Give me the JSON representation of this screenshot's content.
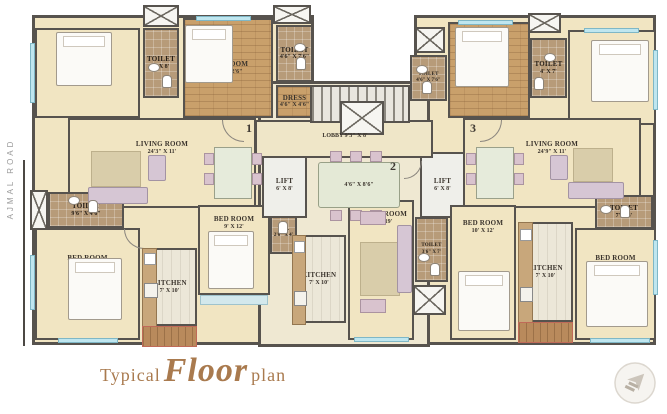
{
  "title": {
    "prefix": "Typical",
    "script": "Floor",
    "suffix": "plan"
  },
  "road_label": "AJMAL ROAD",
  "unit_markers": [
    "1",
    "2",
    "3"
  ],
  "lobby": {
    "name": "LOBBY",
    "dims": "9'3\" X 8'"
  },
  "central_table_dims": "4'6\" X 8'6\"",
  "rooms": [
    {
      "id": "bed-tl1",
      "name": "BED ROOM",
      "dims": "13'6\" X 10'6\""
    },
    {
      "id": "toilet-tl",
      "name": "TOILET",
      "dims": "4' X 8'"
    },
    {
      "id": "bed-tl2",
      "name": "BED ROOM",
      "dims": "13' X 12'6\""
    },
    {
      "id": "toilet-t2",
      "name": "TOILET",
      "dims": "4'6\" X 7'6\""
    },
    {
      "id": "dress-1",
      "name": "DRESS",
      "dims": "4'6\" X 4'6\""
    },
    {
      "id": "living-left",
      "name": "LIVING ROOM",
      "dims": "24'3\" X 11'"
    },
    {
      "id": "toilet-left",
      "name": "TOILET",
      "dims": "9'6\" X 4'6\""
    },
    {
      "id": "bed-bl",
      "name": "BED ROOM",
      "dims": "13' X 10'9\""
    },
    {
      "id": "kitchen-left",
      "name": "KITCHEN",
      "dims": "7' X 10'"
    },
    {
      "id": "bed-bc",
      "name": "BED ROOM",
      "dims": "9' X 12'"
    },
    {
      "id": "wc-center",
      "name": "W.C.",
      "dims": "2'6\" X 4'"
    },
    {
      "id": "kitchen-center",
      "name": "KITCHEN",
      "dims": "7' X 10'"
    },
    {
      "id": "living-center",
      "name": "LIVING ROOM",
      "dims": "10' X 19'"
    },
    {
      "id": "toilet-center",
      "name": "TOILET",
      "dims": "3'6\" X 7'"
    },
    {
      "id": "lift-left",
      "name": "LIFT",
      "dims": "6' X 8'"
    },
    {
      "id": "lift-right",
      "name": "LIFT",
      "dims": "6' X 8'"
    },
    {
      "id": "toilet-r1",
      "name": "TOILET",
      "dims": "4'6\" X 7'6\""
    },
    {
      "id": "bed-tr1",
      "name": "BED ROOM",
      "dims": "10'6\" X 12'6\""
    },
    {
      "id": "toilet-r2",
      "name": "TOILET",
      "dims": "4' X 7'"
    },
    {
      "id": "bed-tr2",
      "name": "BED ROOM",
      "dims": "12' X 10'6\""
    },
    {
      "id": "living-right",
      "name": "LIVING ROOM",
      "dims": "24'9\" X 11'"
    },
    {
      "id": "bed-br1",
      "name": "BED ROOM",
      "dims": "10' X 12'"
    },
    {
      "id": "toilet-right",
      "name": "TOILET",
      "dims": "7' X 4'"
    },
    {
      "id": "kitchen-right",
      "name": "KITCHEN",
      "dims": "7' X 10'"
    },
    {
      "id": "bed-br2",
      "name": "BED ROOM",
      "dims": "10'6\" X 11'"
    }
  ],
  "colors": {
    "wall": "#57534e",
    "floor_cream": "#f1e5c2",
    "floor_wood": "#c9a06b",
    "floor_toilet": "#b79b79",
    "window_blue": "#bfe6ef",
    "title_brown": "#a97a4e",
    "road_gray": "#9a9a9a"
  }
}
